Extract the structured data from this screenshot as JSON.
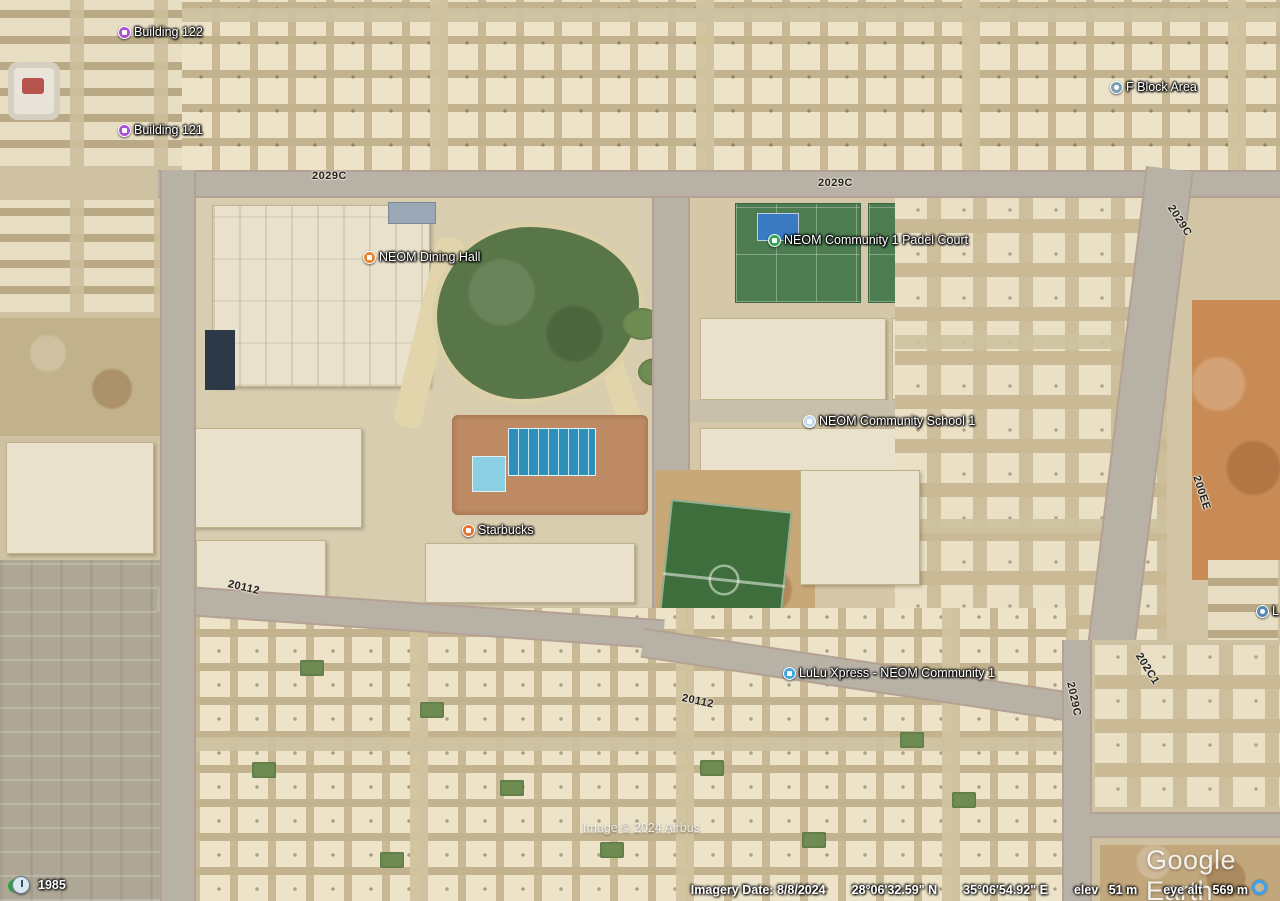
{
  "app": {
    "watermark": "Google Earth",
    "attribution": "Image © 2024 Airbus"
  },
  "status_bar": {
    "imagery_date_label": "Imagery Date:",
    "imagery_date": "8/8/2024",
    "latitude": "28°06'32.59\" N",
    "longitude": "35°06'54.92\" E",
    "elev_label": "elev",
    "elevation": "51 m",
    "eye_alt_label": "eye alt",
    "eye_altitude": "569 m"
  },
  "time_slider": {
    "year": "1985"
  },
  "markers": [
    {
      "name": "building-122",
      "label": "Building 122",
      "icon": "building-icon",
      "color": "#a94fd8",
      "x": 118,
      "y": 25
    },
    {
      "name": "building-121",
      "label": "Building 121",
      "icon": "building-icon",
      "color": "#a94fd8",
      "x": 118,
      "y": 123
    },
    {
      "name": "f-block-area",
      "label": "F Block Area",
      "icon": "pin-icon",
      "color": "#7aa0b8",
      "x": 1110,
      "y": 80
    },
    {
      "name": "neom-dining-hall",
      "label": "NEOM Dining Hall",
      "icon": "restaurant-icon",
      "color": "#e8862e",
      "x": 363,
      "y": 250
    },
    {
      "name": "neom-community-1-padel-court",
      "label": "NEOM Community 1 Padel Court",
      "icon": "sports-icon",
      "color": "#2fa84f",
      "x": 768,
      "y": 233
    },
    {
      "name": "neom-community-school-1",
      "label": "NEOM Community School 1",
      "icon": "school-icon",
      "color": "#c2d9ec",
      "x": 803,
      "y": 414
    },
    {
      "name": "starbucks",
      "label": "Starbucks",
      "icon": "coffee-icon",
      "color": "#e8732e",
      "x": 462,
      "y": 523
    },
    {
      "name": "lulu-xpress-neom-community-1",
      "label": "LuLu Xpress - NEOM Community 1",
      "icon": "cart-icon",
      "color": "#42a7e0",
      "x": 783,
      "y": 666
    },
    {
      "name": "edge-placemark",
      "label": "L",
      "icon": "pin-icon",
      "color": "#5b88b0",
      "x": 1256,
      "y": 604
    }
  ],
  "road_labels": [
    {
      "text": "2029C",
      "x": 312,
      "y": 170,
      "rotation": 0
    },
    {
      "text": "2029C",
      "x": 818,
      "y": 177,
      "rotation": 0
    },
    {
      "text": "2029C",
      "x": 1170,
      "y": 200,
      "rotation": 57
    },
    {
      "text": "200EE",
      "x": 1196,
      "y": 470,
      "rotation": 72
    },
    {
      "text": "202C1",
      "x": 1138,
      "y": 648,
      "rotation": 58
    },
    {
      "text": "2029C",
      "x": 1070,
      "y": 676,
      "rotation": 78
    },
    {
      "text": "20112",
      "x": 228,
      "y": 578,
      "rotation": 13
    },
    {
      "text": "20112",
      "x": 682,
      "y": 692,
      "rotation": 12
    }
  ]
}
